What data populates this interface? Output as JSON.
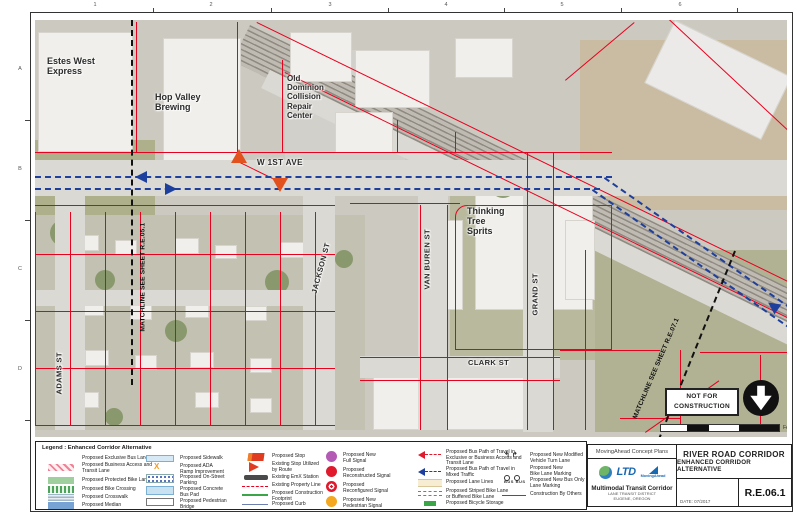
{
  "sheet": {
    "grid_numbers": [
      "1",
      "2",
      "3",
      "4",
      "5",
      "6"
    ],
    "grid_letters": [
      "A",
      "B",
      "C",
      "D"
    ]
  },
  "map": {
    "labels": {
      "estes": "Estes West\nExpress",
      "hop_valley": "Hop Valley\nBrewing",
      "old_dominion": "Old\nDominion\nCollision\nRepair\nCenter",
      "thinking_tree": "Thinking\nTree\nSprits",
      "w_1st_ave": "W 1ST AVE",
      "jackson": "JACKSON ST",
      "van_buren": "VAN BUREN ST",
      "grand": "GRAND ST",
      "clark": "CLARK ST",
      "adams": "ADAMS ST",
      "matchline_left": "MATCHLINE SEE SHEET R.E.05.1",
      "matchline_right": "MATCHLINE SEE SHEET R.E.07.1",
      "not_for_construction": "NOT FOR\nCONSTRUCTION",
      "scale_unit": "Feet"
    }
  },
  "legend": {
    "title": "Legend : Enhanced Corridor Alternative",
    "ada_x": "X",
    "bus_text": "BUS",
    "turn_glyphs": "↰ ↱",
    "col1": [
      {
        "icon": "exclusive-bus-lane-swatch",
        "label": "Proposed Exclusive Bus Lane"
      },
      {
        "icon": "bat-lane-swatch",
        "label": "Proposed Business Access and\nTransit Lane"
      },
      {
        "icon": "protected-bike-lane-swatch",
        "label": "Proposed Protected Bike Lane"
      },
      {
        "icon": "bike-crossing-swatch",
        "label": "Proposed Bike Crossing"
      },
      {
        "icon": "crosswalk-swatch",
        "label": "Proposed Crosswalk"
      },
      {
        "icon": "median-swatch",
        "label": "Proposed Median"
      }
    ],
    "col2": [
      {
        "icon": "sidewalk-swatch",
        "label": "Proposed Sidewalk"
      },
      {
        "icon": "ada-ramp-icon",
        "label": "Proposed ADA\nRamp Improvement"
      },
      {
        "icon": "on-street-parking-swatch",
        "label": "Proposed On-Street\nParking"
      },
      {
        "icon": "concrete-bus-pad-swatch",
        "label": "Proposed Concrete\nBus Pad"
      },
      {
        "icon": "pedestrian-bridge-swatch",
        "label": "Proposed Pedestrian\nBridge"
      }
    ],
    "col3": [
      {
        "icon": "proposed-stop-icon",
        "label": "Proposed Stop"
      },
      {
        "icon": "existing-stop-icon",
        "label": "Existing Stop Utilized\nby Route"
      },
      {
        "icon": "emx-station-icon",
        "label": "Existing EmX Station"
      },
      {
        "icon": "property-line-icon",
        "label": "Existing Property Line"
      },
      {
        "icon": "construction-footprint-icon",
        "label": "Proposed Construction\nFootprint"
      },
      {
        "icon": "curb-icon",
        "label": "Proposed Curb"
      }
    ],
    "col4": [
      {
        "icon": "full-signal-icon",
        "label": "Proposed New\nFull Signal"
      },
      {
        "icon": "reconstructed-signal-icon",
        "label": "Proposed\nReconstructed Signal"
      },
      {
        "icon": "reconfigured-signal-icon",
        "label": "Proposed\nReconfigured Signal"
      },
      {
        "icon": "pedestrian-signal-icon",
        "label": "Proposed New\nPedestrian Signal"
      }
    ],
    "col5": [
      {
        "icon": "bus-path-exclusive-arrow",
        "label": "Proposed Bus Path of Travel in\nExclusive or Business Access and\nTransit Lane"
      },
      {
        "icon": "bus-path-mixed-arrow",
        "label": "Proposed Bus Path of Travel in\nMixed Traffic"
      },
      {
        "icon": "lane-lines-swatch",
        "label": "Proposed Lane Lines"
      },
      {
        "icon": "striped-bike-lane-icon",
        "label": "Proposed Striped Bike Lane\nor Buffered Bike Lane"
      },
      {
        "icon": "bicycle-storage-icon",
        "label": "Proposed Bicycle Storage"
      }
    ],
    "col6": [
      {
        "icon": "vehicle-turn-lane-icon",
        "label": "Proposed New Modified\nVehicle Turn Lane"
      },
      {
        "icon": "bike-lane-marking-icon",
        "label": "Proposed New\nBike Lane Marking"
      },
      {
        "icon": "bus-only-marking-icon",
        "label": "Proposed New Bus Only\nLane Marking"
      },
      {
        "icon": "construction-by-others-icon",
        "label": "Construction By Others"
      }
    ]
  },
  "titleblock": {
    "concept_plans": "MovingAhead Concept Plans",
    "project_title_1": "RIVER ROAD CORRIDOR",
    "project_title_2": "ENHANCED CORRIDOR ALTERNATIVE",
    "sheet_number": "R.E.06.1",
    "org_name": "Multimodal Transit Corridor",
    "org_line1": "LANE TRANSIT DISTRICT",
    "org_line2": "EUGENE, OREGON",
    "date": "DATE: 07/2017",
    "ltd_logo": "LTD",
    "movingahead_logo": "MovingAhead"
  },
  "colors": {
    "parcel_red": "#e8001f",
    "transit_blue": "#1d3f9e",
    "stop_orange": "#e2521e",
    "signal_purple": "#b35ab5",
    "signal_red": "#e01a2c",
    "signal_yellow": "#f3a81f",
    "construction_green": "#3aa648",
    "ltd_blue": "#1768b3"
  }
}
